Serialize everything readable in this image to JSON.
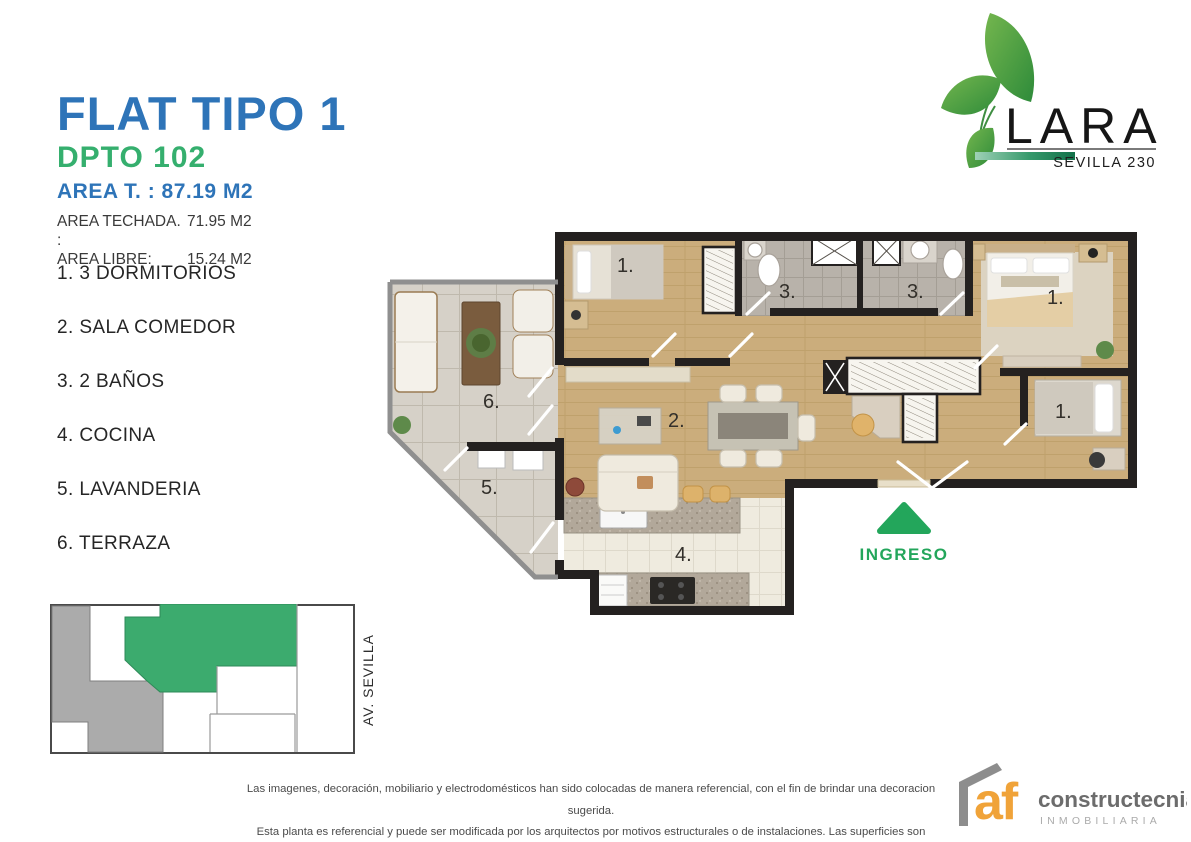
{
  "header": {
    "title": "FLAT TIPO 1",
    "unit": "DPTO 102",
    "area_total": "AREA T. : 87.19 M2",
    "areas": [
      {
        "label": "AREA TECHADA. :",
        "value": "71.95 M2"
      },
      {
        "label": "AREA LIBRE:",
        "value": "15.24 M2"
      }
    ]
  },
  "legend": {
    "items": [
      "1. 3 DORMITORIOS",
      "2. SALA COMEDOR",
      "3. 2 BAÑOS",
      "4. COCINA",
      "5. LAVANDERIA",
      "6. TERRAZA"
    ]
  },
  "brand": {
    "name": "LARA",
    "project": "SEVILLA 230"
  },
  "floorplan": {
    "entrance_label": "INGRESO",
    "labels": {
      "bedroom1": "1.",
      "master_bedroom": "1.",
      "bedroom3": "1.",
      "living_dining": "2.",
      "bathroom1": "3.",
      "bathroom2": "3.",
      "kitchen": "4.",
      "laundry": "5.",
      "terrace": "6."
    }
  },
  "siteplan": {
    "street_label": "AV. SEVILLA"
  },
  "footer": {
    "disclaimer": [
      "Las imagenes, decoración, mobiliario y electrodomésticos han sido colocadas de manera referencial, con el fin de brindar una decoracion sugerida.",
      "Esta planta es referencial y puede ser modificada por los arquitectos por motivos estructurales o de instalaciones. Las superficies son aproximadas"
    ],
    "developer": {
      "abbr": "af",
      "name": "constructecnia",
      "tagline": "INMOBILIARIA"
    }
  },
  "colors": {
    "blue": "#2E74B8",
    "green": "#35AF6E",
    "ingreso": "#23A65B",
    "wall": "#242120",
    "wood": "#CBAD7C",
    "woodline": "#B4975F",
    "ttile": "#D6D1C8",
    "btile": "#B8B2AA",
    "ktile": "#EFEBDF",
    "afor": "#F0A339",
    "sgreen": "#3CAB6E",
    "sgray": "#ABABAB"
  }
}
